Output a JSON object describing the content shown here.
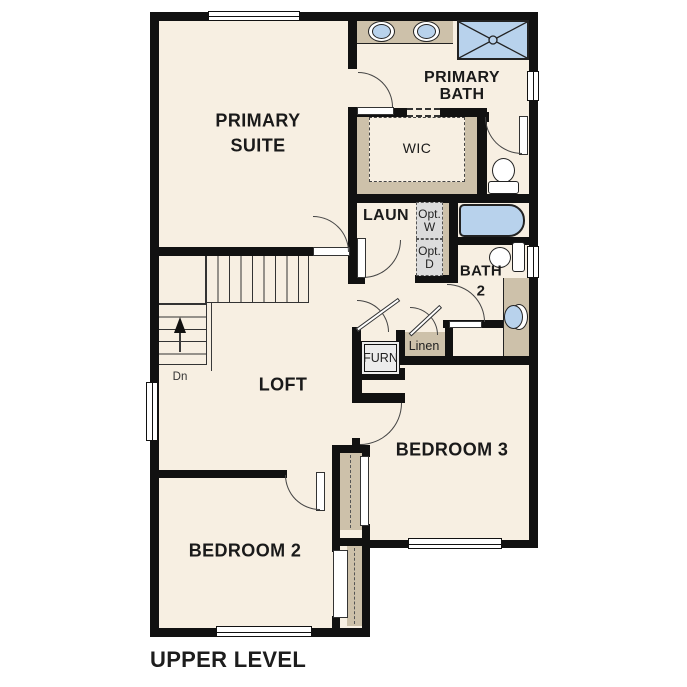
{
  "plan_title": "UPPER LEVEL",
  "rooms": {
    "primary_suite": {
      "line1": "PRIMARY",
      "line2": "SUITE"
    },
    "primary_bath": {
      "line1": "PRIMARY",
      "line2": "BATH"
    },
    "wic": {
      "label": "WIC"
    },
    "laundry": {
      "label": "LAUN"
    },
    "opt_washer": {
      "line1": "Opt.",
      "line2": "W"
    },
    "opt_dryer": {
      "line1": "Opt.",
      "line2": "D"
    },
    "bath2": {
      "line1": "BATH",
      "line2": "2"
    },
    "linen": {
      "label": "Linen"
    },
    "furnace": {
      "label": "FURN"
    },
    "loft": {
      "label": "LOFT"
    },
    "bedroom3": {
      "label": "BEDROOM 3"
    },
    "bedroom2": {
      "label": "BEDROOM 2"
    }
  },
  "stairs": {
    "direction_label": "Dn"
  },
  "colors": {
    "background": "#ffffff",
    "floor": "#f7efe2",
    "wall": "#111111",
    "cabinet_tan": "#cdc1aa",
    "fixture_blue": "#b8d2ec",
    "appliance_gray": "#dcdcdc",
    "line": "#3a3a3a",
    "text": "#1a1a1a"
  }
}
